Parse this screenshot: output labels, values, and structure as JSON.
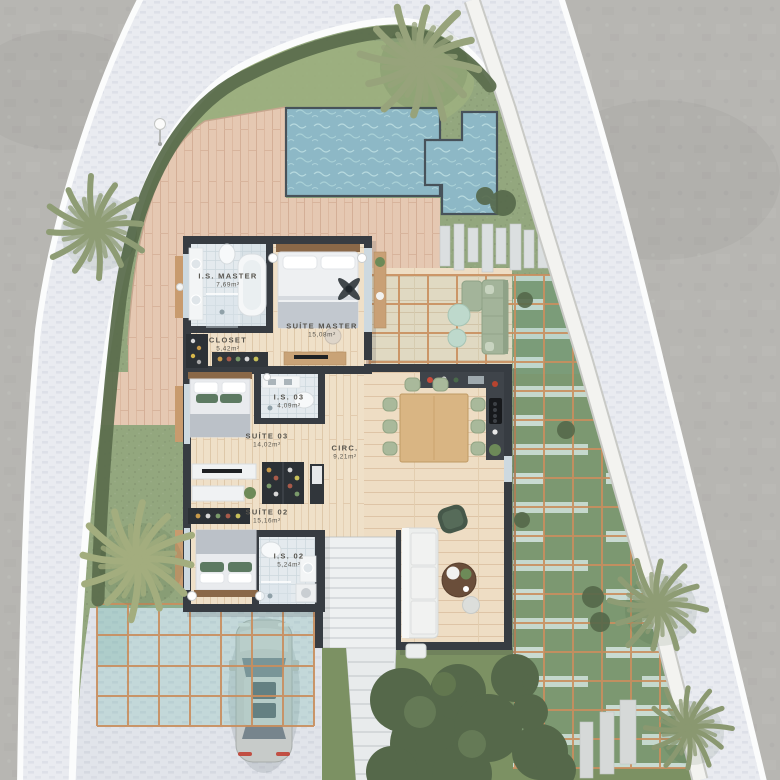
{
  "rooms": [
    {
      "name": "I.S. MASTER",
      "area": "7,69m²"
    },
    {
      "name": "CLOSET",
      "area": "5,42m²"
    },
    {
      "name": "SUÍTE MASTER",
      "area": "15,08m²"
    },
    {
      "name": "I.S. 03",
      "area": "4,09m²"
    },
    {
      "name": "SUÍTE 03",
      "area": "14,02m²"
    },
    {
      "name": "CIRC.",
      "area": "9,21m²"
    },
    {
      "name": "SUÍTE 02",
      "area": "15,16m²"
    },
    {
      "name": "I.S. 02",
      "area": "5,24m²"
    }
  ],
  "features": {
    "scene": "residential-site-floor-plan-render",
    "icons": [
      "palm-tree-icon",
      "swimming-pool-icon",
      "plunge-pool-icon",
      "car-top-view-icon",
      "pergola-grid-icon",
      "staircase-icon",
      "ceiling-fan-icon",
      "bed-icon",
      "sofa-icon",
      "dining-table-icon",
      "bathtub-icon",
      "toilet-icon",
      "light-post-icon",
      "hedge-icon",
      "stepping-stones-icon"
    ]
  },
  "colors": {
    "concrete": "#b7b6b2",
    "road_paver": "#e9ebf0",
    "curb": "#fbfcfc",
    "boundary_wall": "#f3f3f0",
    "grass": "#93a77e",
    "grass_dark": "#7c9163",
    "hedge": "#5c6e4e",
    "deck_wood": "#e5c8b2",
    "interior_wood": "#efe0c8",
    "living_wood": "#eeddc4",
    "bath_tile": "#e4eaee",
    "water": "#8db8c6",
    "house_wall": "#373c42",
    "pergola_frame": "#c98f5f",
    "glass_teal": "#7ebcb2",
    "sage": "#a3b49a",
    "mint": "#bed9cc",
    "bush": "#55684a",
    "palm": "#8e9c74",
    "car_body": "#c7cbc9",
    "stair": "#eef0f1",
    "label_text": "#57544d"
  }
}
